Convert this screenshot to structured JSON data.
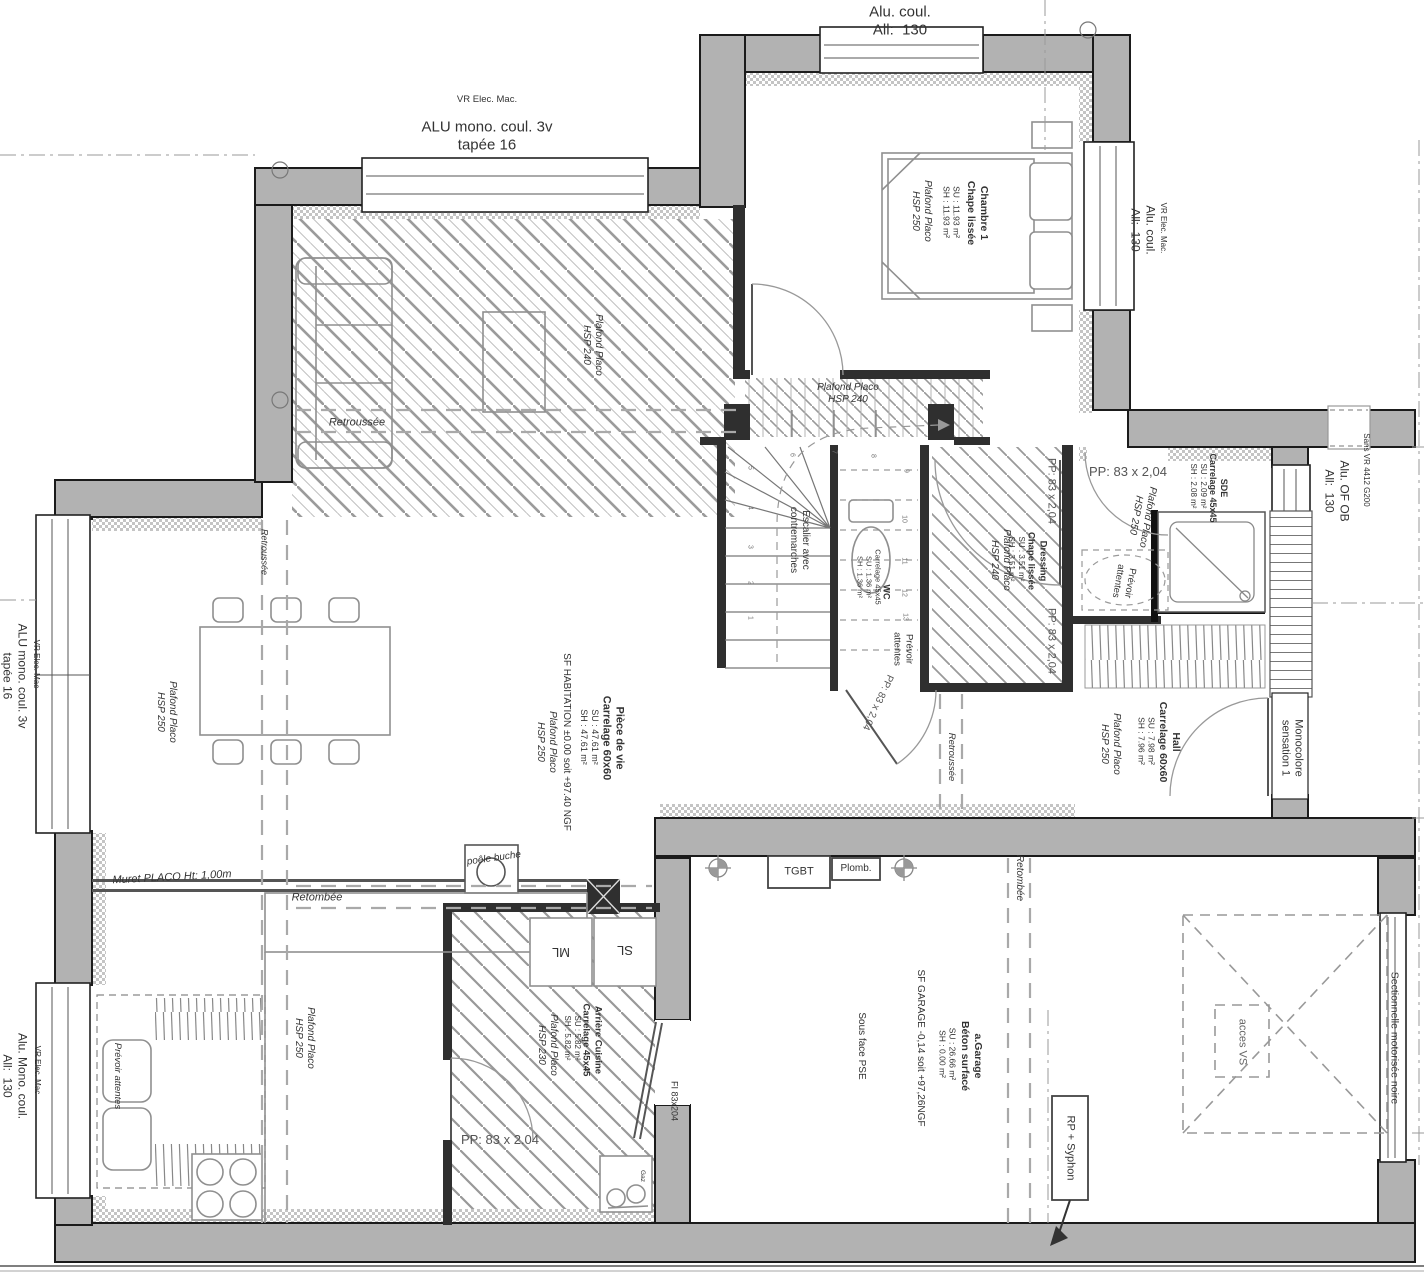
{
  "drawing_type": "floor-plan-rdc",
  "colors": {
    "wall_fill": "#b2b2b2",
    "wall_stroke": "#1b1b1b",
    "hatch": "#9b9b9b",
    "text": "#333333",
    "dash": "#a9a9a9"
  },
  "labels": [
    {
      "n": "win-top-label",
      "t": "Alu. coul.\nAll:  130",
      "x": 900,
      "y": 22,
      "r": 0,
      "s": 15
    },
    {
      "n": "vr-topleft-label",
      "t": "VR Elec. Mac.",
      "x": 487,
      "y": 100,
      "r": 0,
      "s": 9.5
    },
    {
      "n": "win-topleft-label",
      "t": "ALU mono. coul. 3v\ntapée 16",
      "x": 487,
      "y": 137,
      "r": 0,
      "s": 15
    },
    {
      "n": "room-chambre-title",
      "t": "Chambre 1\nChape lissée",
      "x": 977,
      "y": 213,
      "r": 90,
      "s": 10.5,
      "w": 1
    },
    {
      "n": "room-chambre-surface",
      "t": "SU : 11.93 m²\nSH : 11.93 m²",
      "x": 951,
      "y": 212,
      "r": 90,
      "s": 8.5
    },
    {
      "n": "room-chambre-ceiling",
      "t": "Plafond Placo\nHSP 250",
      "x": 921,
      "y": 211,
      "r": 90,
      "s": 10,
      "i": 1
    },
    {
      "n": "win-bedroom-vr-label",
      "t": "VR Elec. Mac.",
      "x": 1163,
      "y": 228,
      "r": 90,
      "s": 8
    },
    {
      "n": "win-bedroom-label",
      "t": "Alu. coul.\nAll:  130",
      "x": 1143,
      "y": 230,
      "r": 90,
      "s": 12
    },
    {
      "n": "living-ceiling-label",
      "t": "Plafond Placo\nHSP 240",
      "x": 592,
      "y": 345,
      "r": 90,
      "s": 10,
      "i": 1
    },
    {
      "n": "living-retroussee-label",
      "t": "Retroussée",
      "x": 357,
      "y": 423,
      "r": 0,
      "s": 11,
      "i": 1
    },
    {
      "n": "corridor-ceiling-label",
      "t": "Plafond Placo\nHSP 240",
      "x": 848,
      "y": 394,
      "r": 0,
      "s": 10,
      "i": 1
    },
    {
      "n": "left-retroussee-label",
      "t": "Retroussée",
      "x": 264,
      "y": 552,
      "r": 90,
      "s": 9,
      "i": 1
    },
    {
      "n": "dining-ceiling-label",
      "t": "Plafond Placo\nHSP 250",
      "x": 166,
      "y": 712,
      "r": 90,
      "s": 10,
      "i": 1
    },
    {
      "n": "left-vr-label",
      "t": "VR Elec. Mac",
      "x": 36,
      "y": 664,
      "r": 90,
      "s": 8
    },
    {
      "n": "win-left-label",
      "t": "ALU mono. coul. 3v\ntapée 16",
      "x": 15,
      "y": 676,
      "r": 90,
      "s": 12
    },
    {
      "n": "sf-habitation-label",
      "t": "SF HABITATION ±0.00 soit +97.40 NGF",
      "x": 566,
      "y": 742,
      "r": 90,
      "s": 10
    },
    {
      "n": "room-pdv-title",
      "t": "Pièce de vie\nCarrelage 60x60",
      "x": 612,
      "y": 738,
      "r": 90,
      "s": 11,
      "w": 1
    },
    {
      "n": "room-pdv-surface",
      "t": "SU : 47.61 m²\nSH : 47.61 m²",
      "x": 589,
      "y": 737,
      "r": 90,
      "s": 9
    },
    {
      "n": "pdv-ceiling-label",
      "t": "Plafond Placo\nHSP 250",
      "x": 546,
      "y": 742,
      "r": 90,
      "s": 10,
      "i": 1
    },
    {
      "n": "stairs-label",
      "t": "Escalier avec\ncontremarches",
      "x": 799,
      "y": 540,
      "r": 90,
      "s": 10
    },
    {
      "n": "room-wc-title",
      "t": "WC",
      "x": 886,
      "y": 592,
      "r": 90,
      "s": 9,
      "w": 1
    },
    {
      "n": "room-wc-surface",
      "t": "Carrelage 45x45\nSU : 1.36 m²\nSH : 1.36 m²",
      "x": 869,
      "y": 577,
      "r": 90,
      "s": 7.5
    },
    {
      "n": "wc-prevoir-label",
      "t": "Prévoir\nattentes",
      "x": 903,
      "y": 649,
      "r": 90,
      "s": 9.5
    },
    {
      "n": "door-wc-label",
      "t": "PP: 83 x 2,04",
      "x": 877,
      "y": 702,
      "r": 115,
      "s": 10,
      "c": "#555"
    },
    {
      "n": "dressing-ceiling-label",
      "t": "Plafond Placo\nHSP 240",
      "x": 1000,
      "y": 560,
      "r": 90,
      "s": 10,
      "i": 1
    },
    {
      "n": "door-pp1-label",
      "t": "PP: 83 x 2,04",
      "x": 1051,
      "y": 491,
      "r": 90,
      "s": 11,
      "c": "#555"
    },
    {
      "n": "door-pp2-label",
      "t": "PP: 83 x 2,04",
      "x": 1051,
      "y": 641,
      "r": 90,
      "s": 11,
      "c": "#555"
    },
    {
      "n": "room-dressing-title",
      "t": "Dressing\nChape lissée",
      "x": 1037,
      "y": 561,
      "r": 90,
      "s": 9.5,
      "w": 1
    },
    {
      "n": "room-dressing-surface",
      "t": "SU : 3.51 m²\nSH : 3.51 m²",
      "x": 1016,
      "y": 559,
      "r": 90,
      "s": 8
    },
    {
      "n": "door-sde-label",
      "t": "PP: 83 x 2,04",
      "x": 1128,
      "y": 472,
      "r": 0,
      "s": 13,
      "c": "#555"
    },
    {
      "n": "sde-ceiling-label",
      "t": "Plafond Placo\nHSP 250",
      "x": 1141,
      "y": 516,
      "r": 100,
      "s": 10,
      "i": 1
    },
    {
      "n": "room-sde-title",
      "t": "SDE\nCarrelage 45x45",
      "x": 1218,
      "y": 488,
      "r": 90,
      "s": 9,
      "w": 1
    },
    {
      "n": "room-sde-surface",
      "t": "SU : 2.09 m²\nSH : 2.08 m²",
      "x": 1198,
      "y": 486,
      "r": 90,
      "s": 8
    },
    {
      "n": "sde-prevoir-label",
      "t": "Prévoir\nattentes",
      "x": 1124,
      "y": 582,
      "r": 100,
      "s": 9.5
    },
    {
      "n": "room-hall-title",
      "t": "Hall\nCarrelage 60x60",
      "x": 1169,
      "y": 742,
      "r": 90,
      "s": 10.5,
      "w": 1
    },
    {
      "n": "room-hall-surface",
      "t": "SU : 7.98 m²\nSH : 7.96 m²",
      "x": 1146,
      "y": 741,
      "r": 90,
      "s": 8.5
    },
    {
      "n": "hall-ceiling-label",
      "t": "Plafond Placo\nHSP 250",
      "x": 1110,
      "y": 744,
      "r": 90,
      "s": 10,
      "i": 1
    },
    {
      "n": "door-entrance-label",
      "t": "Monocolore\nsensation 1",
      "x": 1291,
      "y": 748,
      "r": 90,
      "s": 11
    },
    {
      "n": "win-sansvr-label",
      "t": "Sans VR 4412 G200",
      "x": 1366,
      "y": 470,
      "r": 90,
      "s": 8
    },
    {
      "n": "win-ofob-label",
      "t": "Alu. OF OB\nAll:  130",
      "x": 1337,
      "y": 491,
      "r": 90,
      "s": 12
    },
    {
      "n": "tgbt-label",
      "t": "TGBT",
      "x": 799,
      "y": 872,
      "r": 0,
      "s": 11
    },
    {
      "n": "plomb-label",
      "t": "Plomb.",
      "x": 856,
      "y": 869,
      "r": 0,
      "s": 10
    },
    {
      "n": "garage-retombee-label",
      "t": "Retombée",
      "x": 1019,
      "y": 878,
      "r": 90,
      "s": 10,
      "i": 1
    },
    {
      "n": "muret-label",
      "t": "Muret PLACO Ht: 1,00m",
      "x": 172,
      "y": 878,
      "r": -3,
      "s": 11,
      "i": 1
    },
    {
      "n": "kitchen-retombee-label",
      "t": "Retombée",
      "x": 317,
      "y": 898,
      "r": 0,
      "s": 11,
      "i": 1
    },
    {
      "n": "poele-label",
      "t": "poêle buche",
      "x": 494,
      "y": 859,
      "r": -8,
      "s": 10,
      "i": 1
    },
    {
      "n": "ml-label",
      "t": "ML",
      "x": 561,
      "y": 952,
      "r": 180,
      "s": 13
    },
    {
      "n": "sl-label",
      "t": "SL",
      "x": 625,
      "y": 950,
      "r": 180,
      "s": 13
    },
    {
      "n": "room-arriere-title",
      "t": "Arrière Cuisine\nCarrelage 45x45",
      "x": 592,
      "y": 1040,
      "r": 90,
      "s": 9.5,
      "w": 1
    },
    {
      "n": "room-arriere-surface",
      "t": "SU : 5.82 m²\nSH : 5.82 m²",
      "x": 572,
      "y": 1038,
      "r": 90,
      "s": 8
    },
    {
      "n": "arriere-ceiling-label",
      "t": "Plafond Placo\nHSP 230",
      "x": 547,
      "y": 1045,
      "r": 90,
      "s": 10,
      "i": 1
    },
    {
      "n": "door-arriere-label",
      "t": "PP: 83 x 2.04",
      "x": 500,
      "y": 1140,
      "r": 0,
      "s": 13,
      "c": "#555"
    },
    {
      "n": "door-fi-label",
      "t": "FI 83x204",
      "x": 674,
      "y": 1101,
      "r": 90,
      "s": 9
    },
    {
      "n": "gaz-label",
      "t": "Gaz",
      "x": 642,
      "y": 1176,
      "r": 90,
      "s": 6.5
    },
    {
      "n": "kitchen-ceiling-label",
      "t": "Plafond Placo\nHSP 250",
      "x": 304,
      "y": 1038,
      "r": 90,
      "s": 10,
      "i": 1
    },
    {
      "n": "kitchen-prevoir-label",
      "t": "Prévoir attentes",
      "x": 117,
      "y": 1076,
      "r": 90,
      "s": 9.5,
      "i": 1
    },
    {
      "n": "bl-vr-label",
      "t": "VR Elec. Mac",
      "x": 37,
      "y": 1070,
      "r": 90,
      "s": 8
    },
    {
      "n": "win-bottomleft-label",
      "t": "Alu. Mono. coul.\nAll:  130",
      "x": 15,
      "y": 1076,
      "r": 90,
      "s": 12
    },
    {
      "n": "room-garage-title",
      "t": "a.Garage\nBéton surfacé",
      "x": 971,
      "y": 1056,
      "r": 90,
      "s": 10.5,
      "w": 1
    },
    {
      "n": "room-garage-surface",
      "t": "SU : 26.66 m²\nSH : 0.00 m²",
      "x": 947,
      "y": 1054,
      "r": 90,
      "s": 8.5
    },
    {
      "n": "sf-garage-label",
      "t": "SF GARAGE -0,14 soit +97,26NGF",
      "x": 920,
      "y": 1048,
      "r": 90,
      "s": 10
    },
    {
      "n": "sous-face-pse-label",
      "t": "Sous face PSE",
      "x": 861,
      "y": 1046,
      "r": 90,
      "s": 10
    },
    {
      "n": "rp-syphon-label",
      "t": "RP + Syphon",
      "x": 1070,
      "y": 1148,
      "r": 90,
      "s": 11
    },
    {
      "n": "garage-door-label",
      "t": "Sectionnelle motorisée noire",
      "x": 1394,
      "y": 1038,
      "r": 90,
      "s": 10.5
    },
    {
      "n": "acces-vs-label",
      "t": "acces VS",
      "x": 1242,
      "y": 1042,
      "r": 90,
      "s": 11,
      "c": "#666"
    },
    {
      "n": "pdv-retroussee-label",
      "t": "Retroussée",
      "x": 951,
      "y": 757,
      "r": 90,
      "s": 9.5,
      "i": 1
    },
    {
      "n": "step-1",
      "t": "1",
      "x": 749,
      "y": 618,
      "r": 90,
      "s": 7,
      "c": "#777"
    },
    {
      "n": "step-2",
      "t": "2",
      "x": 749,
      "y": 583,
      "r": 90,
      "s": 7,
      "c": "#777"
    },
    {
      "n": "step-3",
      "t": "3",
      "x": 749,
      "y": 547,
      "r": 90,
      "s": 7,
      "c": "#777"
    },
    {
      "n": "step-4",
      "t": "4",
      "x": 749,
      "y": 508,
      "r": 90,
      "s": 7,
      "c": "#777"
    },
    {
      "n": "step-5",
      "t": "5",
      "x": 749,
      "y": 468,
      "r": 90,
      "s": 7,
      "c": "#777"
    },
    {
      "n": "step-6",
      "t": "6",
      "x": 791,
      "y": 455,
      "r": 90,
      "s": 7,
      "c": "#777"
    },
    {
      "n": "step-7",
      "t": "7",
      "x": 833,
      "y": 452,
      "r": 90,
      "s": 7,
      "c": "#777"
    },
    {
      "n": "step-8",
      "t": "8",
      "x": 872,
      "y": 456,
      "r": 90,
      "s": 7,
      "c": "#777"
    },
    {
      "n": "step-9",
      "t": "9",
      "x": 905,
      "y": 471,
      "r": 90,
      "s": 7,
      "c": "#777"
    },
    {
      "n": "step-10",
      "t": "10",
      "x": 903,
      "y": 519,
      "r": 90,
      "s": 7,
      "c": "#777"
    },
    {
      "n": "step-11",
      "t": "11",
      "x": 903,
      "y": 561,
      "r": 90,
      "s": 7,
      "c": "#777"
    },
    {
      "n": "step-12",
      "t": "12",
      "x": 903,
      "y": 593,
      "r": 90,
      "s": 7,
      "c": "#777"
    },
    {
      "n": "step-13",
      "t": "13",
      "x": 904,
      "y": 617,
      "r": 90,
      "s": 7,
      "c": "#777"
    }
  ]
}
